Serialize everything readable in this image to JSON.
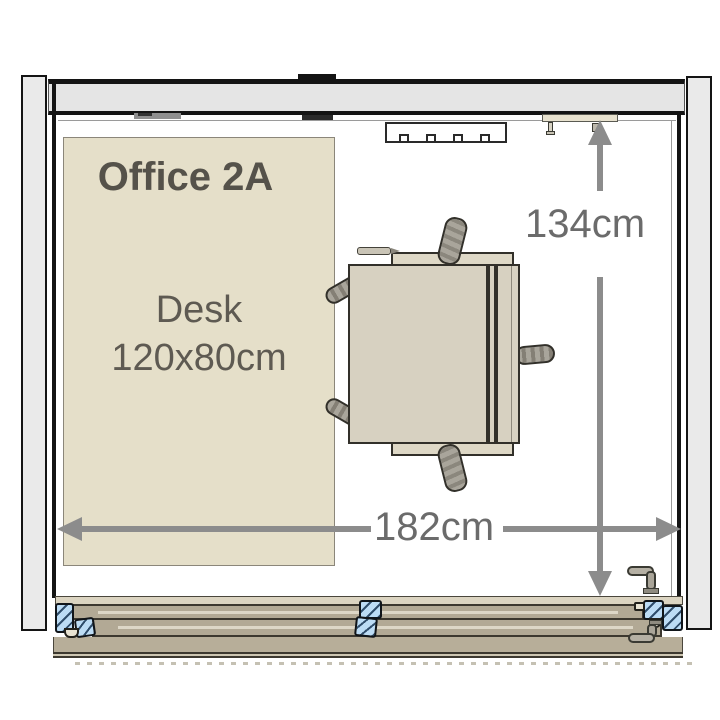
{
  "plan": {
    "type": "office floor plan, top view",
    "room": {
      "name": "Office 2A"
    },
    "desk": {
      "name": "Desk",
      "size": "120x80cm"
    },
    "dimensions": {
      "depth": "134cm",
      "width": "182cm"
    },
    "colors": {
      "wall": "#e5e5e5",
      "zone_fill": "#e5dfc9",
      "desk_fill": "#d7d1c1",
      "door_frame_fill": "#b2a995",
      "frame_section_blue": "#bcdcf5",
      "dimension_gray": "#8c8c8c",
      "label_dark": "#55524a"
    },
    "icons": [
      "wall-vent-icon",
      "curtain-rail-icon",
      "door-handle-icon",
      "office-chair-icon",
      "dimension-arrow-icon"
    ]
  }
}
